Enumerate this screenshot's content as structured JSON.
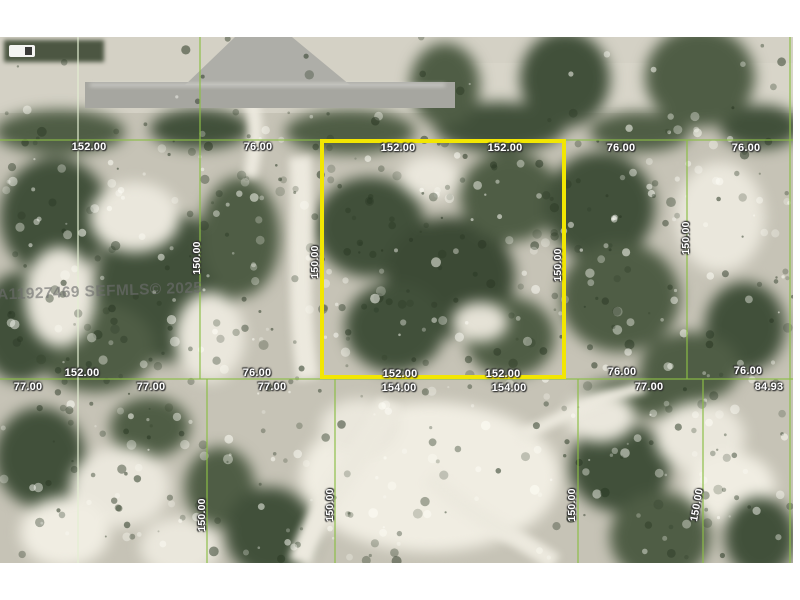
{
  "watermark": {
    "text": "A11927469 SEFMLS© 2025"
  },
  "theme": {
    "highlight": "#f2e602",
    "grid_line": "#8cbe46",
    "label_color": "#ffffff",
    "watermark_color": "#6e6e6e"
  },
  "dims": {
    "top_row": [
      "152.00",
      "76.00",
      "152.00",
      "152.00",
      "76.00",
      "76.00"
    ],
    "mid_upper_row": [
      "152.00",
      "76.00",
      "152.00",
      "152.00",
      "76.00",
      "76.00"
    ],
    "mid_lower_row": [
      "77.00",
      "77.00",
      "77.00",
      "154.00",
      "154.00",
      "77.00",
      "84.93"
    ],
    "vertical_upper": [
      "150.00",
      "150.00",
      "150.00",
      "150.00"
    ],
    "vertical_lower": [
      "150.00",
      "150.00",
      "150.00",
      "150.00"
    ]
  }
}
